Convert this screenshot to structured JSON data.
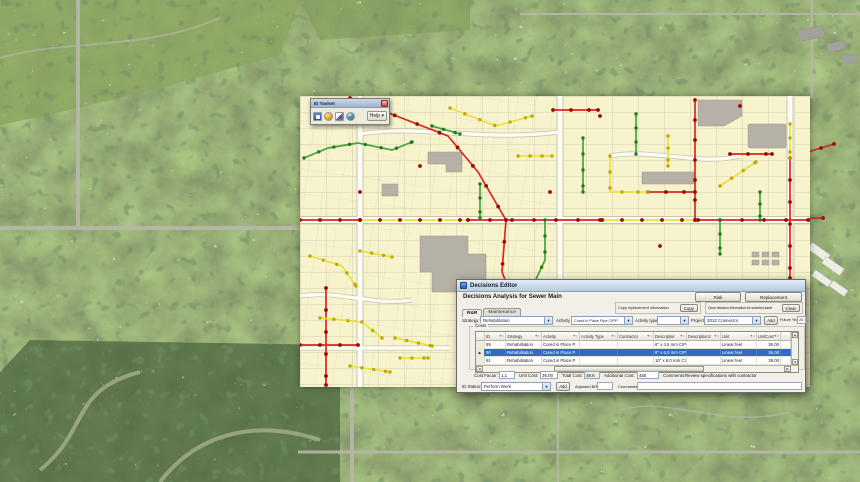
{
  "toolbar_window": {
    "title": "ID Toolset",
    "help_label": "Help"
  },
  "dialog": {
    "window_title": "Decisions Editor",
    "heading": "Decisions Analysis for Sewer Main",
    "actions": {
      "risk": "Risk",
      "replacement": "Replacement",
      "copy_info_label": "Copy replacement information",
      "copy": "Copy",
      "clear_info_label": "Clear decision information for selected asset",
      "clear": "Clear",
      "add_project": "Add",
      "add_status": "Add"
    },
    "tabs": [
      {
        "label": "R&R",
        "active": true
      },
      {
        "label": "Maintenance",
        "active": false
      }
    ],
    "labels": {
      "strategy": "Strategy:",
      "activity": "Activity",
      "activity_type": "Activity type",
      "project": "Project",
      "future_year": "Future Year",
      "costs_group": "Costs",
      "cost_factor": "Cost Factor:",
      "unit_cost": "Unit Cost:",
      "total_cost": "Total Cost:",
      "additional_cost": "Additional Cost:",
      "comments": "Comments:",
      "id_status": "ID Status:",
      "adjusted_brl": "Adjusted BRL",
      "comments2": "Comments"
    },
    "fields": {
      "strategy": "Rehabilitation",
      "activity": "Cured in Place Pipe CIPP",
      "activity_type": "",
      "project": "2012 Connector",
      "future_year": "2012",
      "cost_factor": "1.1",
      "unit_cost": "36.00",
      "total_cost": "39.6",
      "additional_cost": "450",
      "comments": "Review specifications with contractor",
      "id_status": "Perform Work",
      "adjusted_brl": "",
      "status_comments": ""
    },
    "grid": {
      "columns": [
        "ID",
        "Strategy",
        "Activity",
        "Activity Type",
        "Contractor",
        "Description",
        "Description2",
        "Unit",
        "UnitCost"
      ],
      "rows": [
        {
          "id": "89",
          "strategy": "Rehabilitation",
          "activity": "Cured in Place P.",
          "activity_type": "",
          "contractor": "",
          "description": "6\" x 4.5 mm CIPP",
          "description2": "",
          "unit": "Linear feet",
          "unit_cost": "36.00",
          "selected": false
        },
        {
          "id": "90",
          "strategy": "Rehabilitation",
          "activity": "Cured in Place P.",
          "activity_type": "",
          "contractor": "",
          "description": "8\" x 6.0 mm CIPP",
          "description2": "",
          "unit": "Linear feet",
          "unit_cost": "36.00",
          "selected": true
        },
        {
          "id": "91",
          "strategy": "Rehabilitation",
          "activity": "Cured in Place P.",
          "activity_type": "",
          "contractor": "",
          "description": "10\" x 6.0 mm CI..",
          "description2": "",
          "unit": "Linear feet",
          "unit_cost": "39.00",
          "selected": false
        }
      ]
    }
  },
  "map": {
    "pipe_colors": {
      "red": "#d8281b",
      "green": "#46a437",
      "yellow": "#e9e23e"
    },
    "selection_color": "#316ac5",
    "parcel_fill": "#f7f3cd"
  }
}
